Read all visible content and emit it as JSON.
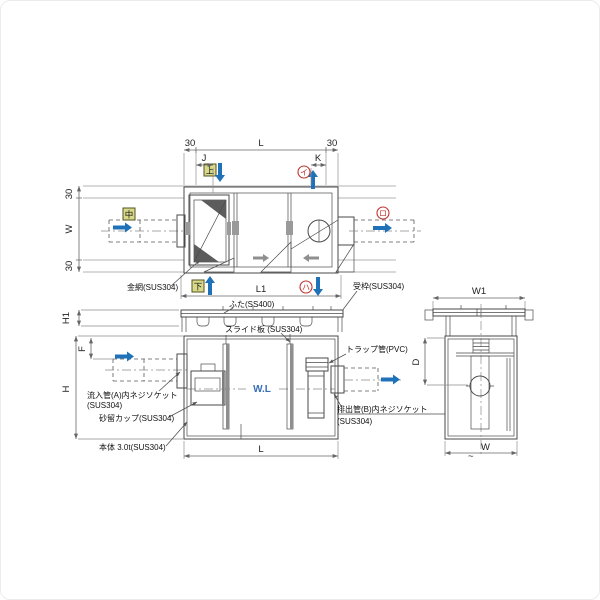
{
  "colors": {
    "line": "#4a4a4a",
    "flow_blue": "#1f72b8",
    "marker_red": "#c23230",
    "marker_yellow": "#d8d98b",
    "water_blue": "#3a6fb7",
    "gray_arrow": "#8f8f8f"
  },
  "plan": {
    "dim_30_left": "30",
    "dim_L": "L",
    "dim_30_right": "30",
    "dim_J": "J",
    "dim_K": "K",
    "dim_30_top": "30",
    "dim_W": "W",
    "dim_30_bottom": "30",
    "dim_L1": "L1",
    "marker_top": "上",
    "marker_middle": "中",
    "marker_bottom": "下",
    "marker_i": "イ",
    "marker_ro": "ロ",
    "marker_ha": "ハ",
    "label_wire_mesh": "金網(SUS304)",
    "label_frame": "受枠(SUS304)"
  },
  "front": {
    "dim_H1": "H1",
    "dim_H": "H",
    "dim_F": "F",
    "dim_L": "L",
    "label_lid": "ふた(SS400)",
    "label_slide_plate": "スライド板 (SUS304)",
    "label_trap_pipe": "トラップ管(PVC)",
    "label_inlet_1": "流入管(A)内ネジソケット",
    "label_inlet_2": "(SUS304)",
    "label_sand_cup": "砂留カップ(SUS304)",
    "label_body": "本体 3.0t(SUS304)",
    "label_outlet_1": "排出管(B)内ネジソケット",
    "label_outlet_2": "(SUS304)",
    "water_level": "W.L"
  },
  "side": {
    "dim_W1": "W1",
    "dim_D": "D",
    "approx": "~",
    "dim_W": "W"
  }
}
